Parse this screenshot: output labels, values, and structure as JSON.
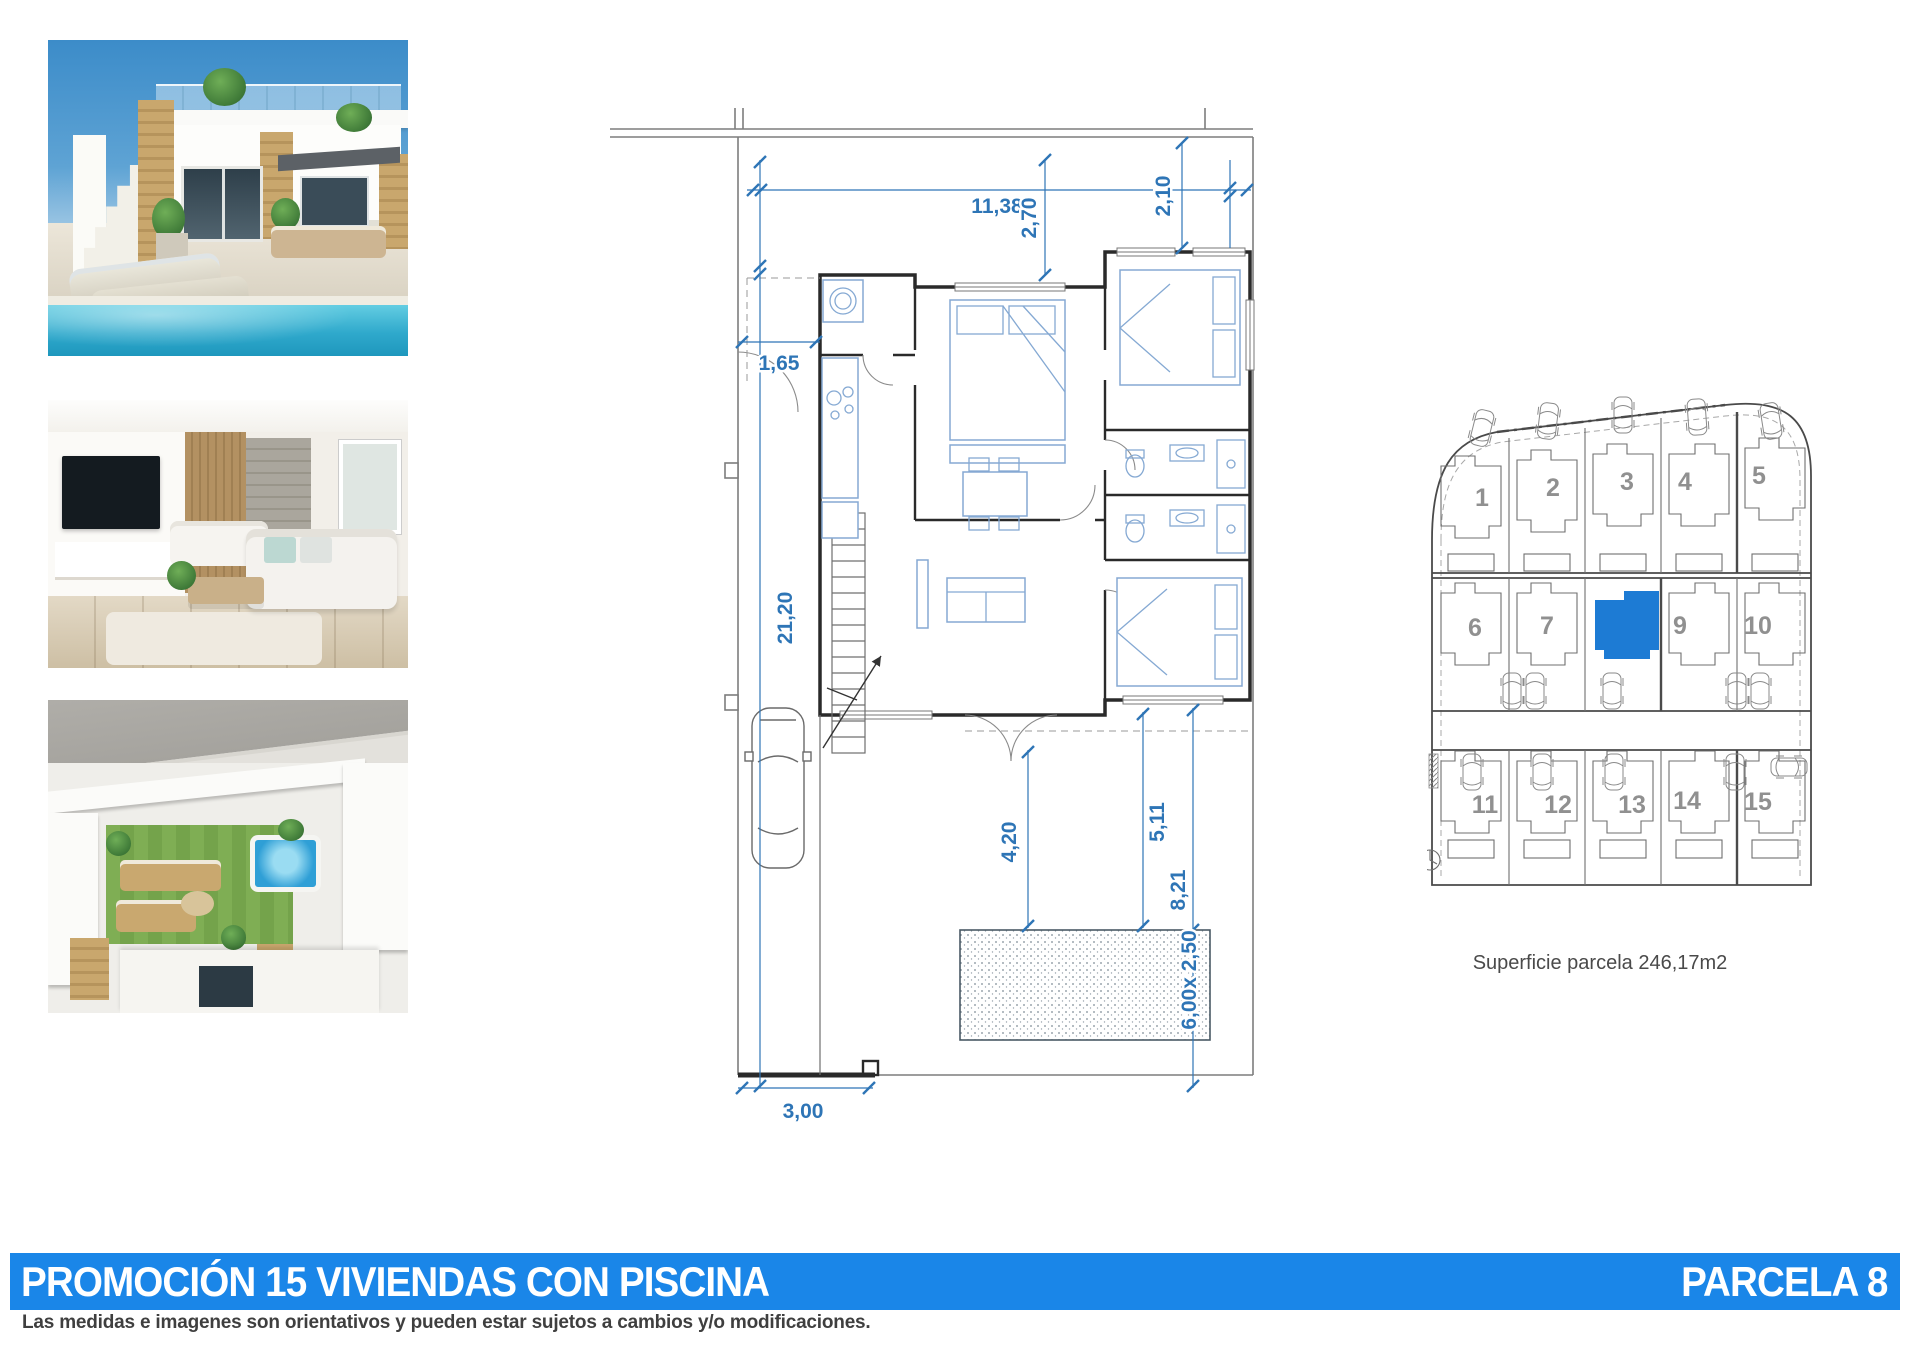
{
  "accent": {
    "bar_color": "#1a86e8",
    "highlight_color": "#1d7bd4",
    "dim_color": "#2e75b6"
  },
  "footer": {
    "title": "PROMOCIÓN 15 VIVIENDAS CON PISCINA",
    "parcel": "PARCELA 8",
    "disclaimer": "Las medidas e imagenes son orientativos y pueden estar sujetos a cambios y/o modificaciones."
  },
  "photos": [
    {
      "name": "villa-exterior-with-pool"
    },
    {
      "name": "living-room-interior"
    },
    {
      "name": "aerial-roof-terraces"
    }
  ],
  "floor_plan": {
    "dims": {
      "total_width": "11,38",
      "porch_depth": "2,70",
      "entry_bay": "2,10",
      "side_passage": "1,65",
      "total_depth": "21,20",
      "terrace_depth": "4,20",
      "pool_to_house": "5,11",
      "garden_depth": "8,21",
      "pool_size": "6,00x 2,50",
      "garage_door": "3,00"
    }
  },
  "site_plan": {
    "caption": "Superficie parcela 246,17m2",
    "highlighted_parcel": "8",
    "parcels": [
      {
        "label": "1"
      },
      {
        "label": "2"
      },
      {
        "label": "3"
      },
      {
        "label": "4"
      },
      {
        "label": "5"
      },
      {
        "label": "6"
      },
      {
        "label": "7"
      },
      {
        "label": "8"
      },
      {
        "label": "9"
      },
      {
        "label": "10"
      },
      {
        "label": "11"
      },
      {
        "label": "12"
      },
      {
        "label": "13"
      },
      {
        "label": "14"
      },
      {
        "label": "15"
      }
    ]
  }
}
